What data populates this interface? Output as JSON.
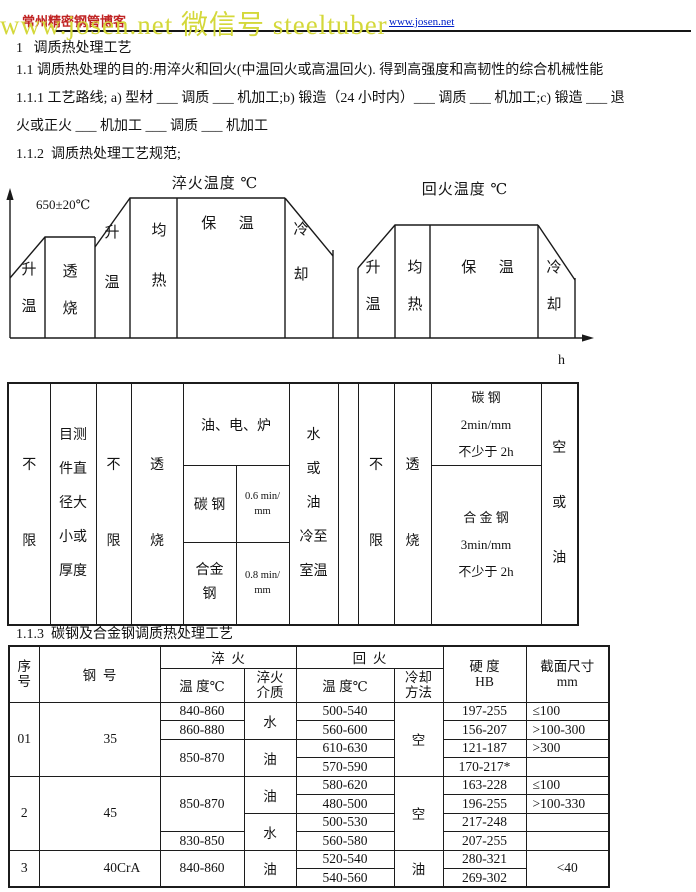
{
  "header": {
    "watermark_text": "www.josen.net 微信号 steeltuber",
    "site_name": "常州精密钢管博客",
    "link_text": "www.josen.net",
    "colors": {
      "watermark": "#d4d83a",
      "site_name": "#c02424",
      "link": "#0020c8"
    }
  },
  "sections": {
    "s1": "1   调质热处理工艺",
    "s1_1": "1.1 调质热处理的目的:用淬火和回火(中温回火或高温回火). 得到高强度和高韧性的综合机械性能",
    "s1_1_1a": "1.1.1 工艺路线; a) 型材 ___ 调质 ___ 机加工;b) 锻造（24 小时内）___ 调质 ___ 机加工;c) 锻造 ___ 退",
    "s1_1_1b": "火或正火 ___ 机加工 ___ 调质 ___ 机加工",
    "s1_1_2": "1.1.2  调质热处理工艺规范;",
    "s1_1_3": "1.1.3  碳钢及合金钢调质热处理工艺"
  },
  "diagram": {
    "quench_title": "淬火温度 ℃",
    "temper_title": "回火温度 ℃",
    "soak_temp": "650±20℃",
    "axis_label": "h",
    "quench_stages": {
      "rise1": "升\n温",
      "soak": "透\n烧",
      "rise2": "升\n温",
      "equalize": "均\n热",
      "hold": "保  温",
      "cool": "冷\n却"
    },
    "temper_stages": {
      "rise": "升\n温",
      "equalize": "均\n热",
      "hold": "保  温",
      "cool": "冷\n却"
    }
  },
  "spec_table": {
    "load": "不\n限",
    "size": "目测\n件直\n径大\n小或\n厚度",
    "time": "不\n限",
    "soak": "透\n烧",
    "equipment": "油、电、炉",
    "carbon_label": "碳 钢",
    "carbon_rate": "0.6 min/\nmm",
    "alloy_label": "合金\n钢",
    "alloy_rate": "0.8 min/\nmm",
    "quench_cooling": "水\n或\n油\n冷至\n室温",
    "temper_time": "不\n限",
    "temper_soak": "透\n烧",
    "temper_carbon": "碳 钢\n2min/mm\n不少于 2h",
    "temper_alloy": "合 金 钢\n3min/mm\n不少于 2h",
    "temper_cooling": "空\n或\n油"
  },
  "process_table": {
    "headers": {
      "seq": "序\n号",
      "grade": "钢  号",
      "quench": "淬  火",
      "temper": "回  火",
      "q_temp": "温 度℃",
      "q_medium": "淬火\n介质",
      "t_temp": "温 度℃",
      "t_cool": "冷却\n方法",
      "hardness": "硬 度\nHB",
      "section": "截面尺寸\nmm"
    },
    "rows": [
      [
        "01",
        "35",
        "840-860",
        "水",
        "500-540",
        "空",
        "197-255",
        "≤100"
      ],
      [
        "860-880",
        "560-600",
        "156-207",
        ">100-300"
      ],
      [
        "850-870",
        "油",
        "610-630",
        "121-187",
        ">300"
      ],
      [
        "570-590",
        "170-217*",
        ""
      ],
      [
        "2",
        "45",
        "850-870",
        "油",
        "580-620",
        "空",
        "163-228",
        "≤100"
      ],
      [
        "480-500",
        "196-255",
        ">100-330"
      ],
      [
        "水",
        "500-530",
        "217-248",
        ""
      ],
      [
        "830-850",
        "560-580",
        "207-255",
        ""
      ],
      [
        "3",
        "40CrA",
        "840-860",
        "油",
        "520-540",
        "油",
        "280-321",
        "<40"
      ],
      [
        "540-560",
        "269-302"
      ]
    ]
  }
}
